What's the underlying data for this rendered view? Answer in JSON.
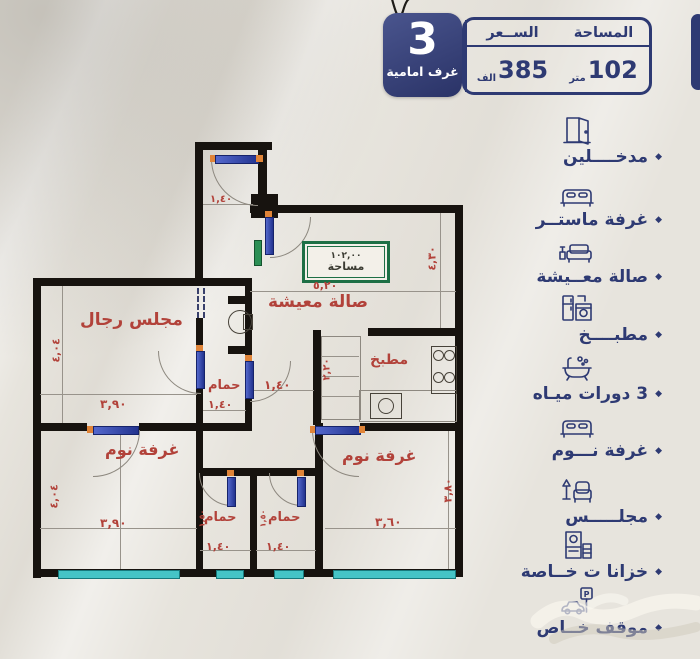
{
  "colors": {
    "navy": "#2e3a73",
    "red": "#b2423a",
    "green_box": "#1d6f45",
    "window_teal": "#45c4c6",
    "door_blue": "#3a4fbe",
    "hinge_orange": "#e08438",
    "background": "#e7e4dd",
    "wall": "#17130f"
  },
  "header": {
    "badge": {
      "number": "3",
      "label": "غرف امامية"
    },
    "table": {
      "area_header": "المساحة",
      "area_value": "102",
      "area_unit": "متر",
      "price_header": "الســعر",
      "price_value": "385",
      "price_unit": "الف"
    }
  },
  "features": {
    "bullet": "◆",
    "items": [
      {
        "icon": "door-icon",
        "label": "مدخــــلين"
      },
      {
        "icon": "bed-icon",
        "label": "غرفة ماستــر"
      },
      {
        "icon": "sofa-icon",
        "label": "صالة معــيشة"
      },
      {
        "icon": "kitchen-icon",
        "label": "مطبــــخ"
      },
      {
        "icon": "bathtub-icon",
        "label": "3 دورات ميـاه"
      },
      {
        "icon": "bed-icon",
        "label": "غرفة نـــوم"
      },
      {
        "icon": "armchair-icon",
        "label": "مجلـــــس"
      },
      {
        "icon": "closet-icon",
        "label": "خزانا ت خــاصة"
      },
      {
        "icon": "parking-icon",
        "label": "موقف خــاص"
      }
    ]
  },
  "plan": {
    "area_box": {
      "value": "١٠٢,٠٠",
      "label": "مساحة"
    },
    "entry": {
      "width": "١,٤٠"
    },
    "living": {
      "label": "صالة معيشة",
      "width": "٥,٢٠",
      "height": "٤,٣٠"
    },
    "majlis": {
      "label": "مجلس رجال",
      "width": "٣,٩٠",
      "height": "٤,٠٤"
    },
    "kitchen": {
      "label": "مطبخ",
      "height": "٢,٢٠"
    },
    "hall": {
      "width": "١,٤٠"
    },
    "bath_mid": {
      "label": "حمام",
      "width": "١,٤٠"
    },
    "bath_left": {
      "label": "حمام",
      "width": "١,٤٠",
      "height": "١,٥٠"
    },
    "bath_right": {
      "label": "حمام",
      "width": "١,٤٠",
      "height": "١,٥٠"
    },
    "bedroom_left": {
      "label": "غرفة نوم",
      "width": "٣,٩٠",
      "height": "٤,٠٤"
    },
    "bedroom_right": {
      "label": "غرفة نوم",
      "width": "٣,٦٠",
      "height": "٣,٨٠"
    }
  }
}
